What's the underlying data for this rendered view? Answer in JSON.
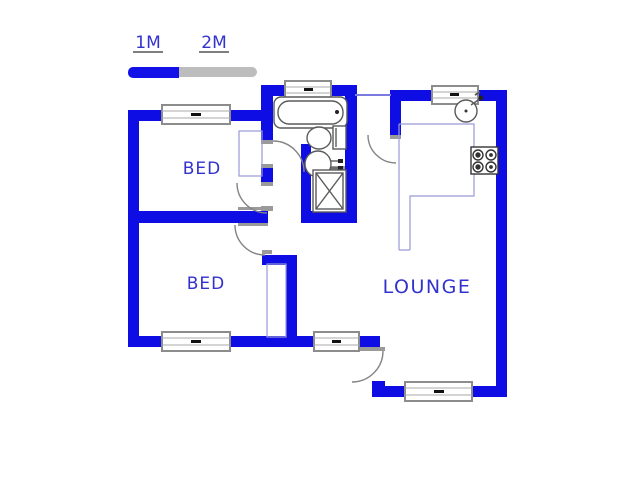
{
  "scale_bar": {
    "label_1m": "1M",
    "label_2m": "2M"
  },
  "rooms": {
    "bed1_label": "BED",
    "bed2_label": "BED",
    "lounge_label": "LOUNGE"
  },
  "fixtures": {
    "bathtub": "bathtub",
    "toilet": "toilet",
    "basin": "basin",
    "shower": "shower",
    "kitchen_sink": "kitchen-sink",
    "stove": "stove-4-burners",
    "wardrobe_bed1": "built-in-cupboard",
    "wardrobe_bed2": "built-in-cupboard",
    "counter": "kitchen-counter"
  },
  "colors": {
    "wall": "#0d0de4",
    "scale_blue": "#1212e8",
    "scale_gray": "#bdbdbd",
    "label_blue": "#3232cd",
    "lintel": "#9a9a9a",
    "arc": "#848484",
    "fixture": "#5a5a5a",
    "thin_blue": "#9a9ad8",
    "connector": "#7a7ae0",
    "window_border": "#8c8c8c",
    "window_dash": "#111111"
  }
}
